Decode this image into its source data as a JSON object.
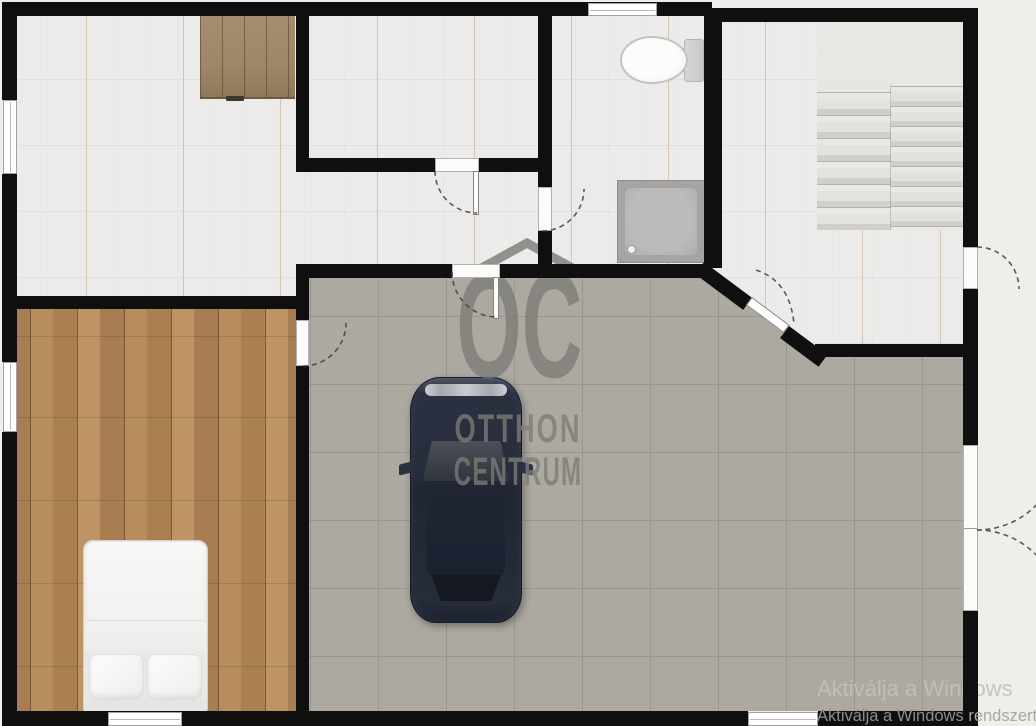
{
  "brand_watermark": {
    "initials": "OC",
    "word1": "OTTHON",
    "word2": "CENTRUM",
    "icon": "house-roof-icon",
    "color": "#7c7b77"
  },
  "os_watermark": {
    "line1": "Aktiválja a Windows",
    "line2_main": "Aktiválja a Windows",
    "line2_tail": " rendszert"
  },
  "floorplan": {
    "furniture": [
      "wardrobe",
      "toilet",
      "shower",
      "staircase",
      "double-bed",
      "suv-car"
    ],
    "colors": {
      "background": "#efeeea",
      "walls": "#0f0f0f",
      "tile_floor": "#ecebe9",
      "living_floor": "#ada9a1",
      "wood_floor": "#b1885c",
      "car_body": "#262c3a"
    }
  }
}
